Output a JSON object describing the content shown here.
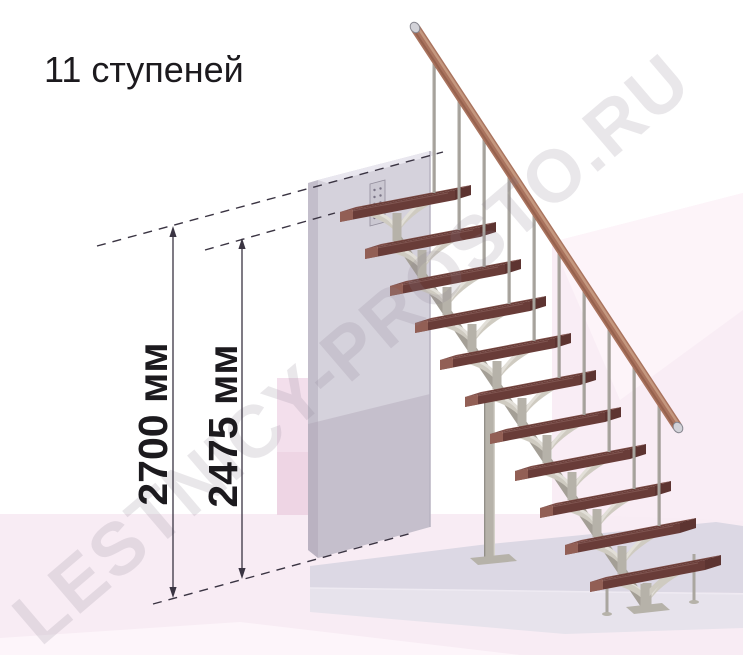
{
  "title": "11 ступеней",
  "watermark": "LESTNICY-PROSTO.RU",
  "dimensions": [
    {
      "id": "total-height",
      "label": "2700 мм",
      "value": 2700,
      "unit": "мм"
    },
    {
      "id": "height-to-top-step",
      "label": "2475 мм",
      "value": 2475,
      "unit": "мм"
    }
  ],
  "stairs": {
    "step_count": 11,
    "baluster_count": 10
  },
  "colors": {
    "background": "#ffffff",
    "floor_pink": "#f8ecf4",
    "floor_pink_light": "#fdf5fa",
    "wall_pink": "#f9edf5",
    "wall_pink_light": "#fdf4f9",
    "strip_pink": "#f3dfec",
    "strip_pink_dark": "#eed5e4",
    "platform_top": "#dcd8e4",
    "platform_front": "#e7e3ec",
    "wall_front": "#d5d2dc",
    "wall_side": "#c3becb",
    "wall_top": "#e9e7ef",
    "wall_shadow": "#a99db0",
    "tread_top": "#7e4d47",
    "tread_front": "#693c38",
    "tread_side": "#5d3431",
    "tread_cap": "#9a655a",
    "metal_light": "#cfcbc1",
    "metal_lighter": "#e2dfd8",
    "metal_mid": "#b6b2a9",
    "metal_dark": "#a49f96",
    "baluster": "#aaa69f",
    "handrail": "#a9735e",
    "handrail_highlight": "#c99d83",
    "rail_cap": "#d2d2d8",
    "rail_cap_edge": "#86868f",
    "dim_line": "#3a3442",
    "text": "#1c1a1e",
    "watermark": "#8a8090"
  }
}
